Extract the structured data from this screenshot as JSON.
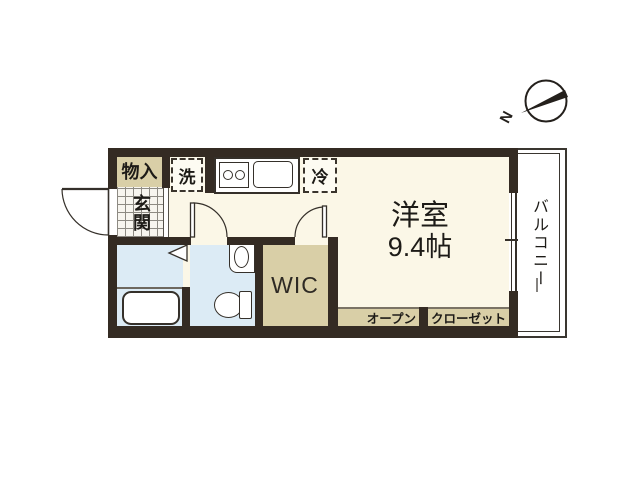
{
  "title": "apartment floor plan",
  "compass": {
    "north_label": "N"
  },
  "rooms": {
    "storage_label": "物入",
    "entrance_label": "玄関",
    "washer_label": "洗",
    "fridge_label": "冷",
    "main_room_label": "洋室",
    "main_room_size": "9.4帖",
    "wic_label": "WIC",
    "open_label": "オープン",
    "closet_label": "クローゼット",
    "balcony_label": "バルコニー"
  },
  "colors": {
    "wall": "#342b23",
    "floor": "#fbf7e7",
    "closet_tan": "#d9cfa7",
    "wet_area_blue": "#dcebf5",
    "outline": "#35302a"
  }
}
